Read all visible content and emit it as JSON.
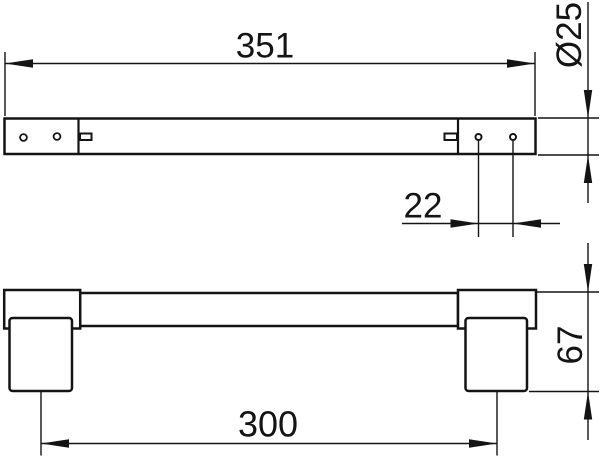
{
  "drawing": {
    "background": "#ffffff",
    "line_color": "#141414",
    "dimensions": {
      "overall_length": "351",
      "bar_diameter": "Ø25",
      "hole_spacing": "22",
      "mounting_centers": "300",
      "overall_height": "67"
    }
  }
}
